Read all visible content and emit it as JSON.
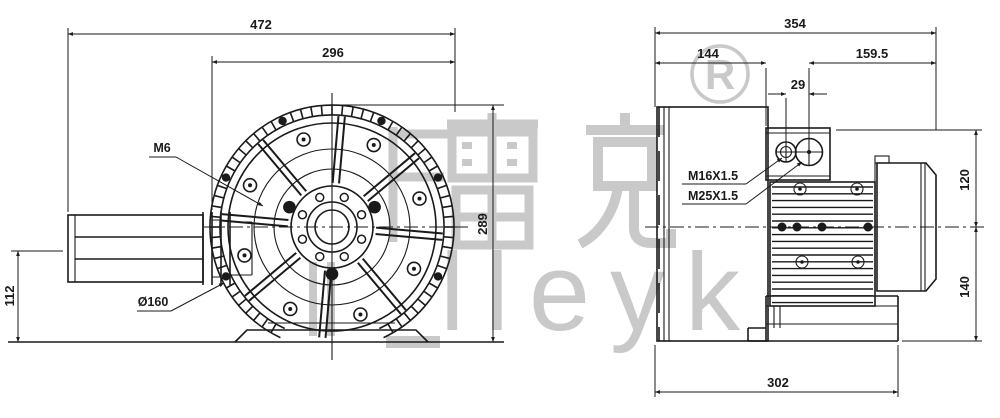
{
  "watermark": {
    "registered_mark": "R",
    "chinese_text": "雷克",
    "latin_text": "lleyk",
    "color": "#c9c9c9"
  },
  "front_view": {
    "dim_overall_width": "472",
    "dim_fan_diameter": "296",
    "dim_overall_height": "289",
    "dim_axis_height": "112",
    "label_thread": "M6",
    "label_flange_diameter": "Ø160"
  },
  "side_view": {
    "dim_overall_depth": "354",
    "dim_housing_depth": "144",
    "dim_motor_depth": "159.5",
    "dim_gland_spacing": "29",
    "dim_height_above_axis": "120",
    "dim_height_below_axis": "140",
    "dim_base_depth": "302",
    "label_gland_small": "M16X1.5",
    "label_gland_large": "M25X1.5"
  },
  "colors": {
    "line": "#1a1a1a",
    "watermark_gray": "#c9c9c9",
    "background": "#ffffff"
  }
}
